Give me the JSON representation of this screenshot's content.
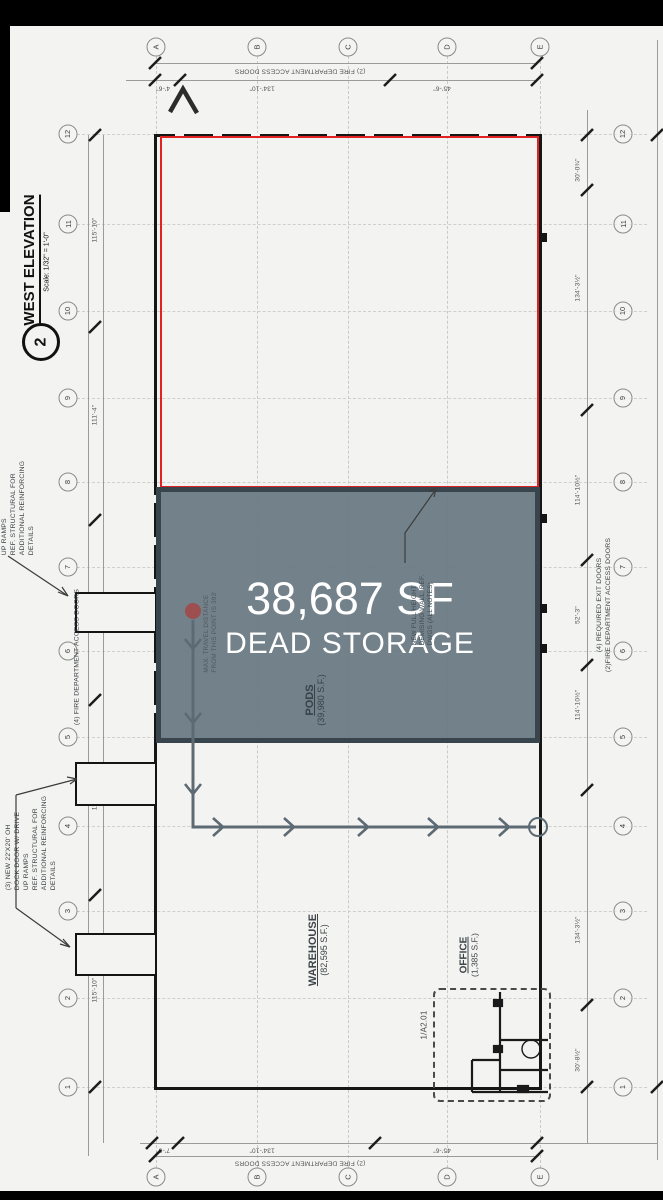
{
  "title_block": {
    "detail_number": "2",
    "title": "WEST ELEVATION",
    "scale": "Scale: 1/32\" = 1'-0\""
  },
  "highlight": {
    "area": "38,687 SF",
    "label": "DEAD STORAGE",
    "fill": "#68787f",
    "border": "#39454c",
    "red_outline": "#e02222"
  },
  "zones": {
    "pods": {
      "name": "PODS",
      "area": "(39,980 S.F.)"
    },
    "warehouse": {
      "name": "WAREHOUSE",
      "area": "(82,595 S.F.)"
    },
    "office": {
      "name": "OFFICE",
      "area": "(1,385 S.F.)"
    },
    "detail_ref": "1/A2.01"
  },
  "grid": {
    "columns": [
      "A",
      "B",
      "C",
      "D",
      "E"
    ],
    "rows": [
      "12",
      "11",
      "10",
      "9",
      "8",
      "7",
      "6",
      "5",
      "4",
      "3",
      "2",
      "1"
    ]
  },
  "dimensions": {
    "top": {
      "note": "(2) FIRE DEPARTMENT ACCESS DOORS",
      "values": [
        "4'-6\"",
        "134'-10\"",
        "45'-6\""
      ]
    },
    "bottom": {
      "note": "(2) FIRE DEPARTMENT ACCESS DOORS",
      "values": [
        "7'-6\"",
        "134'-10\"",
        "45'-6\""
      ]
    },
    "left": {
      "values": [
        "115'-10\"",
        "111'-4\"",
        "122'-6\"",
        "111'-6\"",
        "115'-10\""
      ]
    },
    "right": {
      "values": [
        "30'-0¾\"",
        "134'-3½\"",
        "114'-10½\"",
        "52'-3\"",
        "114'-10½\"",
        "134'-3½\"",
        "30'-8½\""
      ]
    }
  },
  "notes": {
    "left_upper": [
      "UP RAMPS",
      "REF. STRUCTURAL FOR",
      "ADDITIONAL REINFORCING",
      "DETAILS"
    ],
    "left_lower": [
      "(3) NEW 22'X20' OH",
      "DOCK DOOR W/ DRIVE",
      "UP RAMPS",
      "REF. STRUCTURAL FOR",
      "ADDITIONAL REINFORCING",
      "DETAILS"
    ],
    "left_wall": "(4) FIRE DEPARTMENT ACCESS DOORS",
    "right_wall": [
      "(4) REQUIRED EXIT DOORS",
      "(2)FIRE DEPARTMENT ACCESS DOORS"
    ],
    "travel": [
      "MAX. TRAVEL DISTANCE",
      "FROM THIS POINT IS 393'"
    ],
    "demising": [
      "NEW FULL HEIGHT",
      "DEMISING WALL, REF.",
      "DWGS (ALL NOTES)"
    ]
  }
}
